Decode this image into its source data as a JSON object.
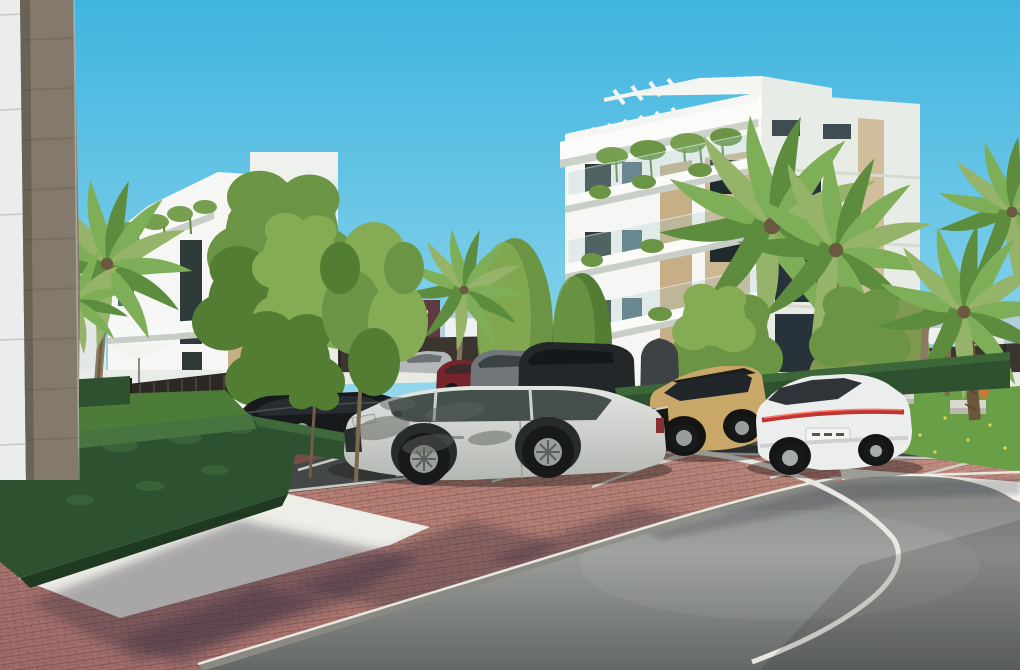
{
  "meta": {
    "type": "architectural-render",
    "description": "3D exterior render of a modern white apartment complex: two white blocks with tan accent strips, roof pergolas and hanging balcony plants, palm trees and clipped hedges, a brick-paved parking court with several cars and a curving asphalt road with a white edge line under a clear cyan sky",
    "width": 1020,
    "height": 670
  },
  "colors": {
    "sky_top": "#3fb4e0",
    "sky_horizon": "#93d7ec",
    "haze": "#bccdd7",
    "distant_building": "#edf1f1",
    "distant_brick": "#5f3a40",
    "fence_dark": "#3a352e",
    "wall_white": "#e9eae4",
    "building_white": "#f6f7f4",
    "building_shade": "#e8ece6",
    "building_tan": "#c6af86",
    "building_tan2": "#cdb892",
    "panel_white": "#ebedec",
    "pillar_tan": "#837a6b",
    "window_dark": "#2e3b3a",
    "window_glass": "#54707a",
    "window_teal": "#9cc4cc",
    "plant_green": "#76a050",
    "hedge_dark": "#2e5130",
    "hedge_light": "#477440",
    "hedge_deep": "#1f3a20",
    "grass": "#4c7c38",
    "grass_bright": "#69a047",
    "tree_light": "#85ab54",
    "tree_mid": "#6b9544",
    "tree_dark": "#527d33",
    "tree_olive": "#7f9a50",
    "palm_green": "#7fae58",
    "palm_dark": "#5d8c3f",
    "palm_pale": "#95b469",
    "trunk": "#8a7a5e",
    "trunk_dark": "#6b583c",
    "brick_base": "#bb8478",
    "brick_shadow": "#7c4f48",
    "gravel": "#eeeee8",
    "parking_asphalt": "#434746",
    "road_mid": "#9a9d99",
    "road_line": "#e8e8e2",
    "kerb": "#8a8a82",
    "sidewalk_white": "#f1f1ea",
    "suv_body": "#d9dcd7",
    "suv_window": "#45504c",
    "tancar_body": "#c8a769",
    "sedan_body": "#eceded",
    "taillight": "#c13434",
    "car_black": "#17191c",
    "car_red": "#76242c",
    "car_gray": "#70767a",
    "car_silver": "#b4b8b8",
    "wheel": "#17191a",
    "rim": "#9a9e9b",
    "bench": "#d8d8d0",
    "sculpture": "#c97a35",
    "parasol": "#f2f3ee"
  },
  "scene": {
    "sky": {
      "condition": "clear"
    },
    "buildings": [
      {
        "id": "foreground-wall",
        "desc": "extreme-left close-up building corner: white cladding panel with seams and a tan rammed-earth pillar"
      },
      {
        "id": "left-apartment-block",
        "desc": "three-storey white block, roof overhang with pergola slats, trailing plants on terrace edge, tan accent strip, dark glazing"
      },
      {
        "id": "right-apartment-block",
        "desc": "four-storey white block, stacked balcony slabs with glass rails and trailing plants, two tan accent strips, roof pergolas and roof boxes"
      }
    ],
    "vehicles": [
      {
        "id": "white-suv",
        "type": "SUV",
        "color": "silver-white",
        "position": "foreground centre, side view facing left, dappled tree shadow on body"
      },
      {
        "id": "tan-crossover",
        "type": "compact crossover",
        "color": "sand gold with black roof and cladding",
        "position": "right of centre, front three-quarter view"
      },
      {
        "id": "white-sedan",
        "type": "fastback sedan",
        "color": "white with full-width red tail light bar",
        "position": "foreground right, rear three-quarter view"
      },
      {
        "id": "black-sedan",
        "type": "sedan",
        "color": "black",
        "position": "mid-left behind street trees"
      },
      {
        "id": "silver-car",
        "type": "car",
        "color": "silver",
        "position": "background parking row"
      },
      {
        "id": "red-hatchback",
        "type": "hatchback",
        "color": "dark red",
        "position": "background parking row"
      },
      {
        "id": "grey-estate",
        "type": "estate",
        "color": "grey",
        "position": "background parking row"
      },
      {
        "id": "black-suv",
        "type": "large SUV",
        "color": "dark grey",
        "position": "background parking row"
      }
    ],
    "vegetation": [
      "fan palms left of left building",
      "tall palm pair in front of right building",
      "shaggy-trunk palm at right edge",
      "row of young street trees along parking bays",
      "large deciduous trees screening both buildings",
      "clipped box hedges in foreground",
      "long hedge wall behind parked cars",
      "lawn with yellow wildflowers at right"
    ],
    "ground": [
      "red clay brick paving with long diagonal tree shadows",
      "white gravel strip along hedge",
      "dark asphalt parking bays with white lines",
      "grey asphalt road curving right with white edge line",
      "grey kerb with white painted edge",
      "bright concrete band beside road"
    ],
    "furniture": [
      "white parasol and sun loungers by pool area",
      "dark slatted garden gate and fence",
      "concrete benches on lawn",
      "orange sculpture on lawn"
    ]
  }
}
